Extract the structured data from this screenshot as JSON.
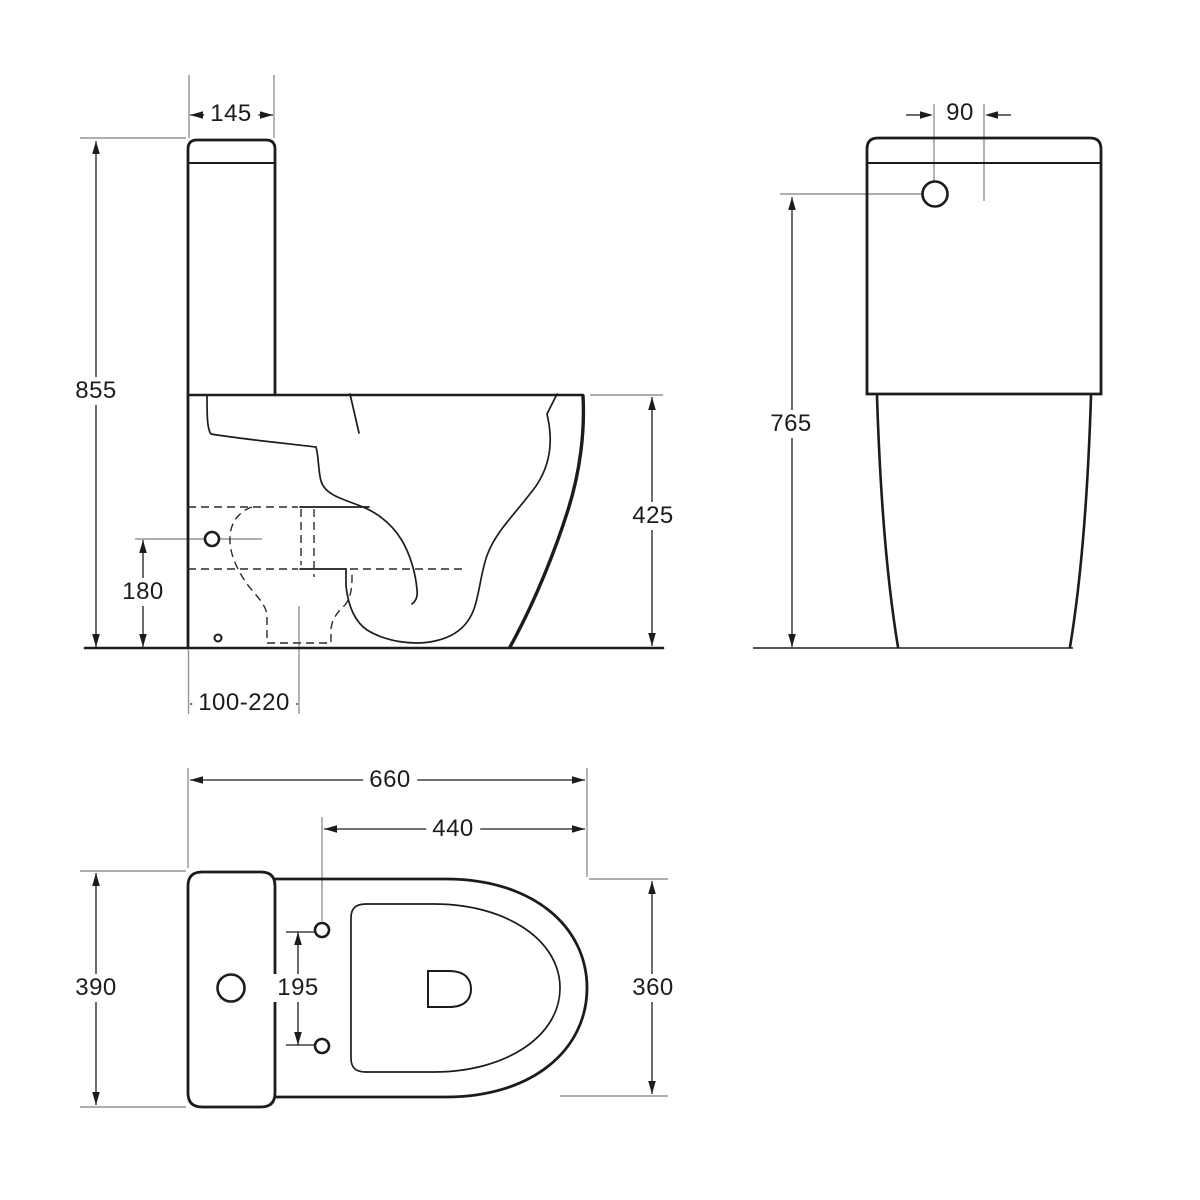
{
  "drawing": {
    "side_view": {
      "dims": {
        "tank_depth": "145",
        "overall_height": "855",
        "bowl_height": "425",
        "outlet_height": "180",
        "outlet_offset_range": "100-220"
      }
    },
    "front_view": {
      "dims": {
        "button_offset": "90",
        "button_height": "765"
      }
    },
    "top_view": {
      "dims": {
        "overall_depth": "660",
        "bowl_depth": "440",
        "overall_width": "390",
        "hinge_hole_spacing": "195",
        "bowl_width": "360"
      }
    },
    "colors": {
      "line": "#1c1c1c",
      "extension_line": "#949494",
      "background": "#ffffff"
    }
  }
}
